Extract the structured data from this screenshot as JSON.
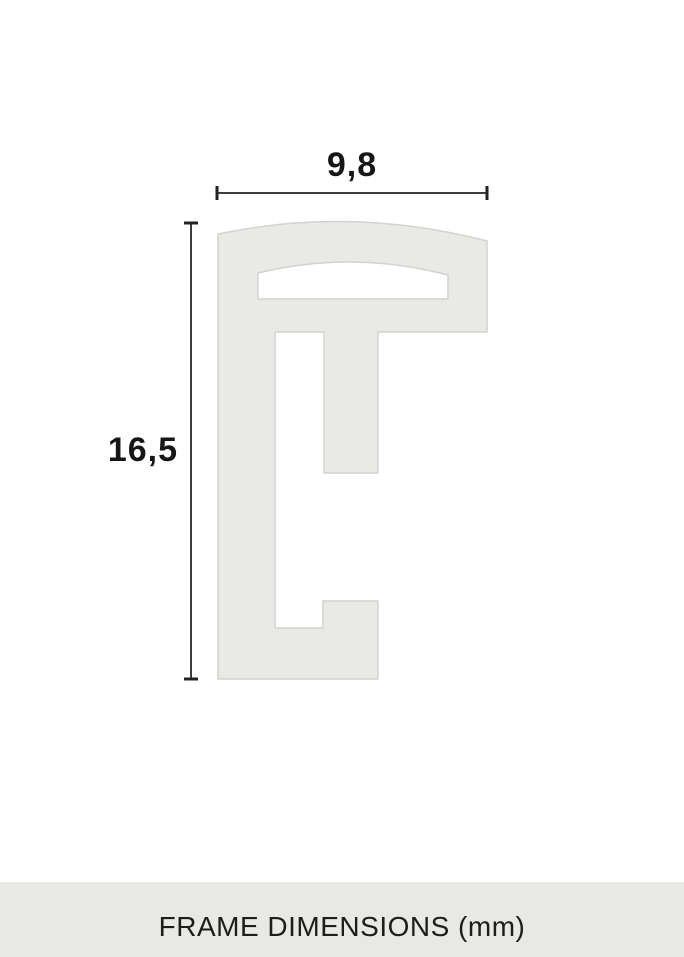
{
  "diagram": {
    "title": "frame profile cross-section",
    "width_dimension": {
      "value": "9,8"
    },
    "height_dimension": {
      "value": "16,5"
    }
  },
  "footer": {
    "label": "FRAME DIMENSIONS (mm)"
  },
  "colors": {
    "shape_fill": "#e9eae5",
    "shape_stroke": "#d2d3cf",
    "dim_line": "#3c3c3c",
    "dim_tick": "#222222",
    "label_text": "#161616",
    "footer_bg": "#e8e9e4",
    "footer_text": "#1d1d1b",
    "page_bg": "#ffffff"
  }
}
